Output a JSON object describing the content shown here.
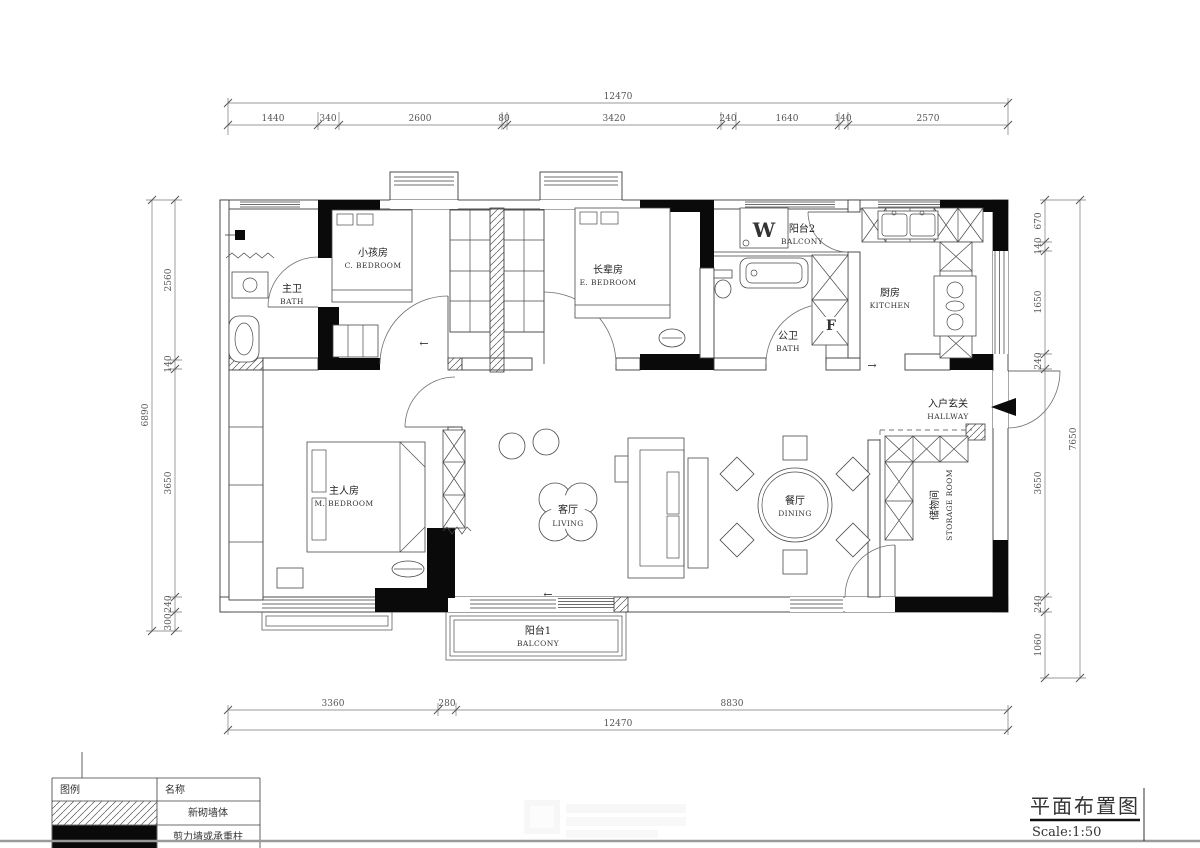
{
  "drawing": {
    "title": "平面布置图",
    "scale": "Scale:1:50"
  },
  "legend": {
    "col_symbol": "图例",
    "col_name": "名称",
    "rows": [
      {
        "name": "新砌墙体"
      },
      {
        "name": "剪力墙或承重柱"
      }
    ]
  },
  "rooms": {
    "c_bedroom": {
      "zh": "小孩房",
      "en": "C. BEDROOM"
    },
    "e_bedroom": {
      "zh": "长辈房",
      "en": "E. BEDROOM"
    },
    "m_bedroom": {
      "zh": "主人房",
      "en": "M. BEDROOM"
    },
    "m_bath": {
      "zh": "主卫",
      "en": "BATH"
    },
    "p_bath": {
      "zh": "公卫",
      "en": "BATH"
    },
    "kitchen": {
      "zh": "厨房",
      "en": "KITCHEN"
    },
    "balcony2": {
      "zh": "阳台2",
      "en": "BALCONY"
    },
    "balcony1": {
      "zh": "阳台1",
      "en": "BALCONY"
    },
    "living": {
      "zh": "客厅",
      "en": "LIVING"
    },
    "dining": {
      "zh": "餐厅",
      "en": "DINING"
    },
    "hallway": {
      "zh": "入户玄关",
      "en": "HALLWAY"
    },
    "storage": {
      "zh": "储物间",
      "en": "STORAGE ROOM"
    }
  },
  "labels": {
    "washer": "W",
    "flue": "F"
  },
  "marks": {
    "arrow_left": "←",
    "arrow_right": "→"
  },
  "dimensions": {
    "top": {
      "total": "12470",
      "segments": [
        "1440",
        "340",
        "2600",
        "80",
        "3420",
        "240",
        "1640",
        "140",
        "2570"
      ]
    },
    "bottom": {
      "total": "12470",
      "segments": [
        "3360",
        "280",
        "8830"
      ]
    },
    "left": {
      "total": "6890",
      "segments": [
        "2560",
        "140",
        "3650",
        "240",
        "300"
      ]
    },
    "right": {
      "total": "7650",
      "segments": [
        "670",
        "140",
        "1650",
        "240",
        "3650",
        "240",
        "1060"
      ]
    }
  }
}
